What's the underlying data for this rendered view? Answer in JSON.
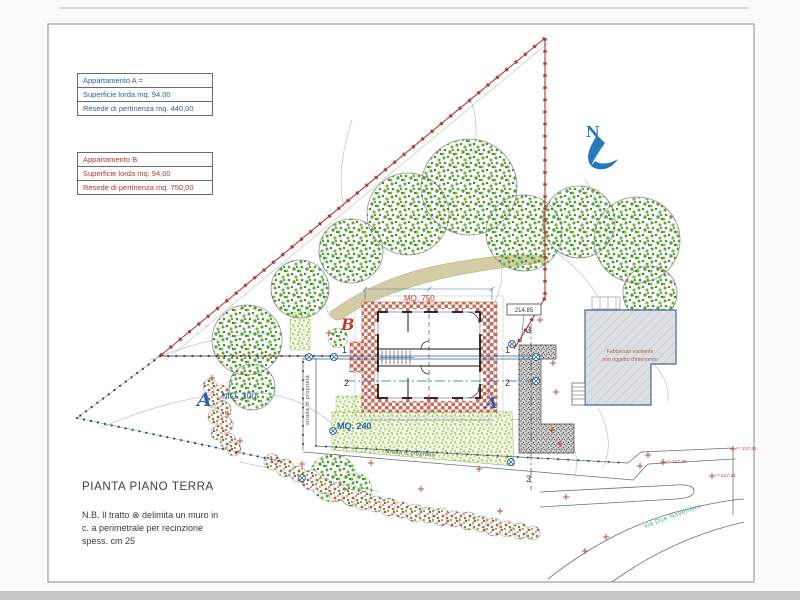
{
  "page": {
    "title_block": {
      "title": "PIANTA PIANO TERRA",
      "note_line1": "N.B.  Il tratto ⊗ delimita un muro in",
      "note_line2": "c. a  perimetrale per recinzione",
      "note_line3": "spess. cm 25"
    },
    "legend_a": {
      "title": "Appartamento  A =",
      "row1": "Superficie lorda  mq. 94,00",
      "row2": "Resede di pertinenza  mq. 440,00"
    },
    "legend_b": {
      "title": "Appartamento  B",
      "row1": "Superficie lorda  mq. 94,00",
      "row2": "Resede di pertinenza  mq. 750,00"
    },
    "north_label": "N",
    "labels": {
      "mq750": "MQ. 750",
      "unit_b": "B",
      "unit_a": "A",
      "area_a": "A",
      "mq200": "MQ. 200",
      "mq240": "MQ. 240",
      "axis1_left": "1",
      "axis1_right": "1",
      "axis2_left": "2",
      "axis2_right": "2",
      "axis3_top": "3",
      "axis3_bottom": "3",
      "private_road_vertical": "strada di proprietà",
      "private_road_horizontal": "strada di proprietà",
      "street_name": "via Due Novembre",
      "elevation_box": "214.85",
      "existing_building_line1": "Fabbricato esistente",
      "existing_building_line2": "non oggetto d'intervento"
    },
    "colors": {
      "wall_red": "#b03a2e",
      "boundary_blue": "#1f4e79",
      "label_blue": "#2e5fa3",
      "label_red": "#c0392b",
      "contour": "#aaccd6",
      "street_label": "#44aab8",
      "north_blue": "#2779bd",
      "brick_hatch": "#cb6a55",
      "lawn_green": "#8abd4e"
    },
    "trees": [
      {
        "x": 247,
        "y": 340,
        "r": 35
      },
      {
        "x": 252,
        "y": 387,
        "r": 23
      },
      {
        "x": 300,
        "y": 289,
        "r": 29
      },
      {
        "x": 351,
        "y": 251,
        "r": 32
      },
      {
        "x": 408,
        "y": 214,
        "r": 41
      },
      {
        "x": 469,
        "y": 187,
        "r": 48
      },
      {
        "x": 524,
        "y": 233,
        "r": 38
      },
      {
        "x": 579,
        "y": 222,
        "r": 36
      },
      {
        "x": 637,
        "y": 240,
        "r": 43
      },
      {
        "x": 650,
        "y": 293,
        "r": 27
      }
    ],
    "bushes": [
      {
        "x": 333,
        "y": 478,
        "r": 24
      },
      {
        "x": 355,
        "y": 490,
        "r": 17
      },
      {
        "x": 338,
        "y": 338,
        "r": 10
      }
    ],
    "hedge": [
      {
        "x": 272,
        "y": 462,
        "r": 8
      },
      {
        "x": 285,
        "y": 468,
        "r": 9
      },
      {
        "x": 298,
        "y": 474,
        "r": 8
      },
      {
        "x": 311,
        "y": 480,
        "r": 10
      },
      {
        "x": 324,
        "y": 486,
        "r": 8
      },
      {
        "x": 337,
        "y": 492,
        "r": 9
      },
      {
        "x": 350,
        "y": 497,
        "r": 8
      },
      {
        "x": 363,
        "y": 501,
        "r": 9
      },
      {
        "x": 376,
        "y": 504,
        "r": 8
      },
      {
        "x": 389,
        "y": 507,
        "r": 9
      },
      {
        "x": 402,
        "y": 510,
        "r": 8
      },
      {
        "x": 415,
        "y": 513,
        "r": 9
      },
      {
        "x": 428,
        "y": 515,
        "r": 8
      },
      {
        "x": 441,
        "y": 517,
        "r": 9
      },
      {
        "x": 454,
        "y": 519,
        "r": 8
      },
      {
        "x": 468,
        "y": 521,
        "r": 9
      },
      {
        "x": 481,
        "y": 524,
        "r": 8
      },
      {
        "x": 494,
        "y": 527,
        "r": 9
      },
      {
        "x": 507,
        "y": 529,
        "r": 8
      },
      {
        "x": 520,
        "y": 531,
        "r": 8
      },
      {
        "x": 533,
        "y": 533,
        "r": 7
      },
      {
        "x": 210,
        "y": 386,
        "r": 7
      },
      {
        "x": 221,
        "y": 393,
        "r": 8
      },
      {
        "x": 213,
        "y": 401,
        "r": 7
      },
      {
        "x": 223,
        "y": 409,
        "r": 8
      },
      {
        "x": 215,
        "y": 417,
        "r": 7
      },
      {
        "x": 225,
        "y": 425,
        "r": 8
      },
      {
        "x": 218,
        "y": 433,
        "r": 7
      },
      {
        "x": 228,
        "y": 441,
        "r": 8
      },
      {
        "x": 234,
        "y": 449,
        "r": 7
      }
    ],
    "survey_markers": [
      {
        "x": 733,
        "y": 449,
        "label": "217.41"
      },
      {
        "x": 663,
        "y": 462,
        "label": "217.20"
      },
      {
        "x": 712,
        "y": 476,
        "label": "217.31"
      },
      {
        "x": 640,
        "y": 466,
        "label": ""
      },
      {
        "x": 648,
        "y": 455,
        "label": ""
      },
      {
        "x": 606,
        "y": 537,
        "label": ""
      },
      {
        "x": 585,
        "y": 551,
        "label": ""
      },
      {
        "x": 566,
        "y": 497,
        "label": ""
      },
      {
        "x": 212,
        "y": 378,
        "label": ""
      },
      {
        "x": 228,
        "y": 414,
        "label": ""
      },
      {
        "x": 240,
        "y": 441,
        "label": ""
      },
      {
        "x": 302,
        "y": 464,
        "label": ""
      },
      {
        "x": 329,
        "y": 333,
        "label": ""
      },
      {
        "x": 371,
        "y": 463,
        "label": ""
      },
      {
        "x": 479,
        "y": 469,
        "label": ""
      },
      {
        "x": 421,
        "y": 489,
        "label": ""
      },
      {
        "x": 540,
        "y": 320,
        "label": ""
      },
      {
        "x": 553,
        "y": 363,
        "label": ""
      },
      {
        "x": 556,
        "y": 392,
        "label": ""
      },
      {
        "x": 552,
        "y": 430,
        "label": ""
      },
      {
        "x": 560,
        "y": 444,
        "label": ""
      },
      {
        "x": 500,
        "y": 511,
        "label": ""
      }
    ],
    "wall_symbols": [
      {
        "x": 309,
        "y": 357
      },
      {
        "x": 334,
        "y": 357
      },
      {
        "x": 333,
        "y": 431
      },
      {
        "x": 511,
        "y": 462
      },
      {
        "x": 302,
        "y": 478
      },
      {
        "x": 536,
        "y": 357
      },
      {
        "x": 536,
        "y": 381
      },
      {
        "x": 512,
        "y": 344
      }
    ]
  }
}
